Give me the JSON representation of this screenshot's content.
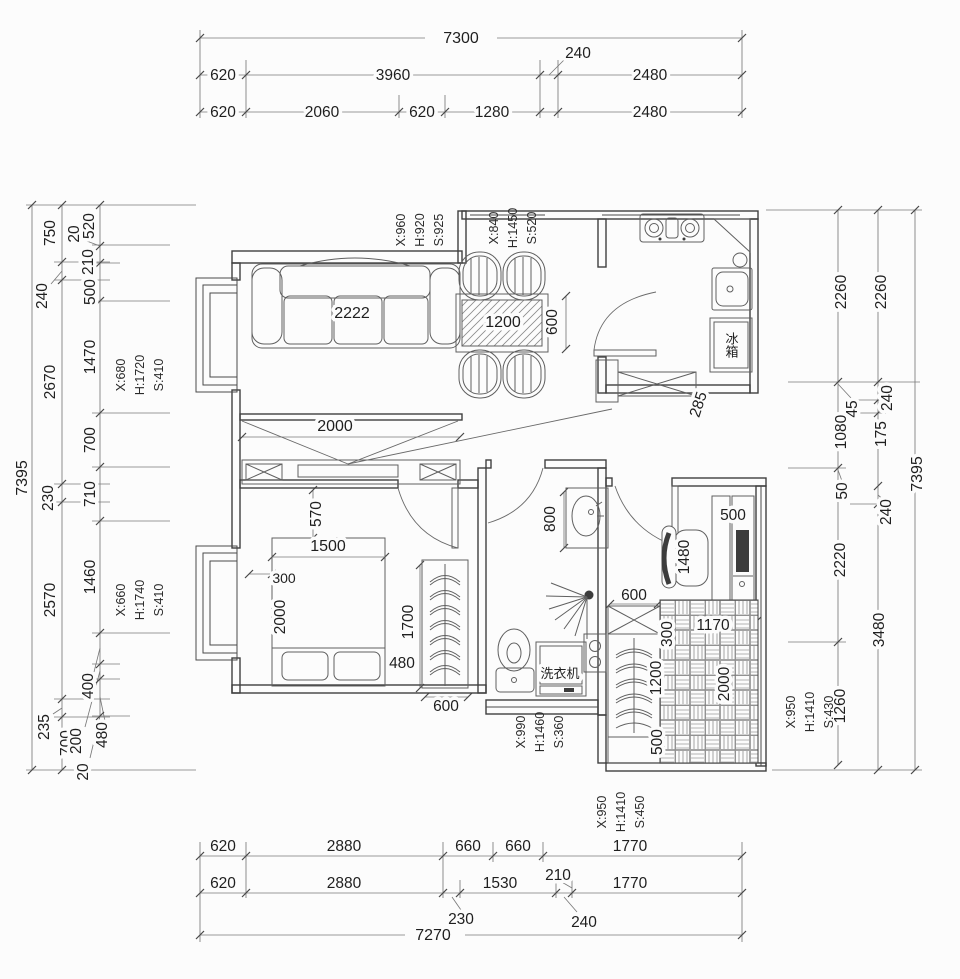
{
  "dims": {
    "top": {
      "total": "7300",
      "row2": [
        "620",
        "3960",
        "240",
        "2480"
      ],
      "row3": [
        "620",
        "2060",
        "620",
        "1280",
        "2480"
      ]
    },
    "bottom": {
      "row1": [
        "620",
        "2880",
        "660",
        "660",
        "1770"
      ],
      "row2": [
        "620",
        "2880",
        "1530",
        "210",
        "1770"
      ],
      "leaders": [
        "230",
        "240"
      ],
      "total": "7270"
    },
    "left": {
      "total": "7395",
      "outer": [
        "750",
        "240",
        "2670",
        "230",
        "2570",
        "235",
        "700"
      ],
      "inner": [
        "520",
        "20",
        "210",
        "500",
        "1470",
        "700",
        "710",
        "1460",
        "400",
        "200",
        "480",
        "20"
      ]
    },
    "right": {
      "total": "7395",
      "outer": [
        "2260",
        "240",
        "175",
        "240",
        "3480"
      ],
      "inner": [
        "2260",
        "45",
        "1080",
        "50",
        "2220",
        "1260"
      ]
    }
  },
  "interior": {
    "living": {
      "sofa": "2222",
      "table_width": "1200",
      "table_depth": "600"
    },
    "hall": {
      "tv_wall": "2000",
      "passage": "570",
      "cabinet": "285"
    },
    "bedroom": {
      "offset": "300",
      "bed_width": "1500",
      "bed_length": "2000",
      "closet_height": "1700",
      "closet_gap": "480",
      "closet_width": "600"
    },
    "bath": {
      "basin": "800",
      "washer": "洗衣机"
    },
    "kitchen": {
      "fridge": "冰箱"
    },
    "study": {
      "desk_depth": "500",
      "chair": "1480",
      "closet_top": "600",
      "bed_offset": "300",
      "bed_width": "1170",
      "closet_length": "1200",
      "bed_length": "2000",
      "closet_bottom": "500"
    }
  },
  "windows": {
    "entry": {
      "s": "S:925",
      "h": "H:920",
      "x": "X:960"
    },
    "kitchen": {
      "s": "S:520",
      "h": "H:1450",
      "x": "X:840"
    },
    "living": {
      "s": "S:410",
      "h": "H:1720",
      "x": "X:680"
    },
    "bedroom": {
      "s": "S:410",
      "h": "H:1740",
      "x": "X:660"
    },
    "study": {
      "s": "S:430",
      "h": "H:1410",
      "x": "X:950"
    },
    "bath": {
      "s": "S:360",
      "h": "H:1460",
      "x": "X:990"
    },
    "balcony": {
      "s": "S:450",
      "h": "H:1410",
      "x": "X:950"
    }
  }
}
